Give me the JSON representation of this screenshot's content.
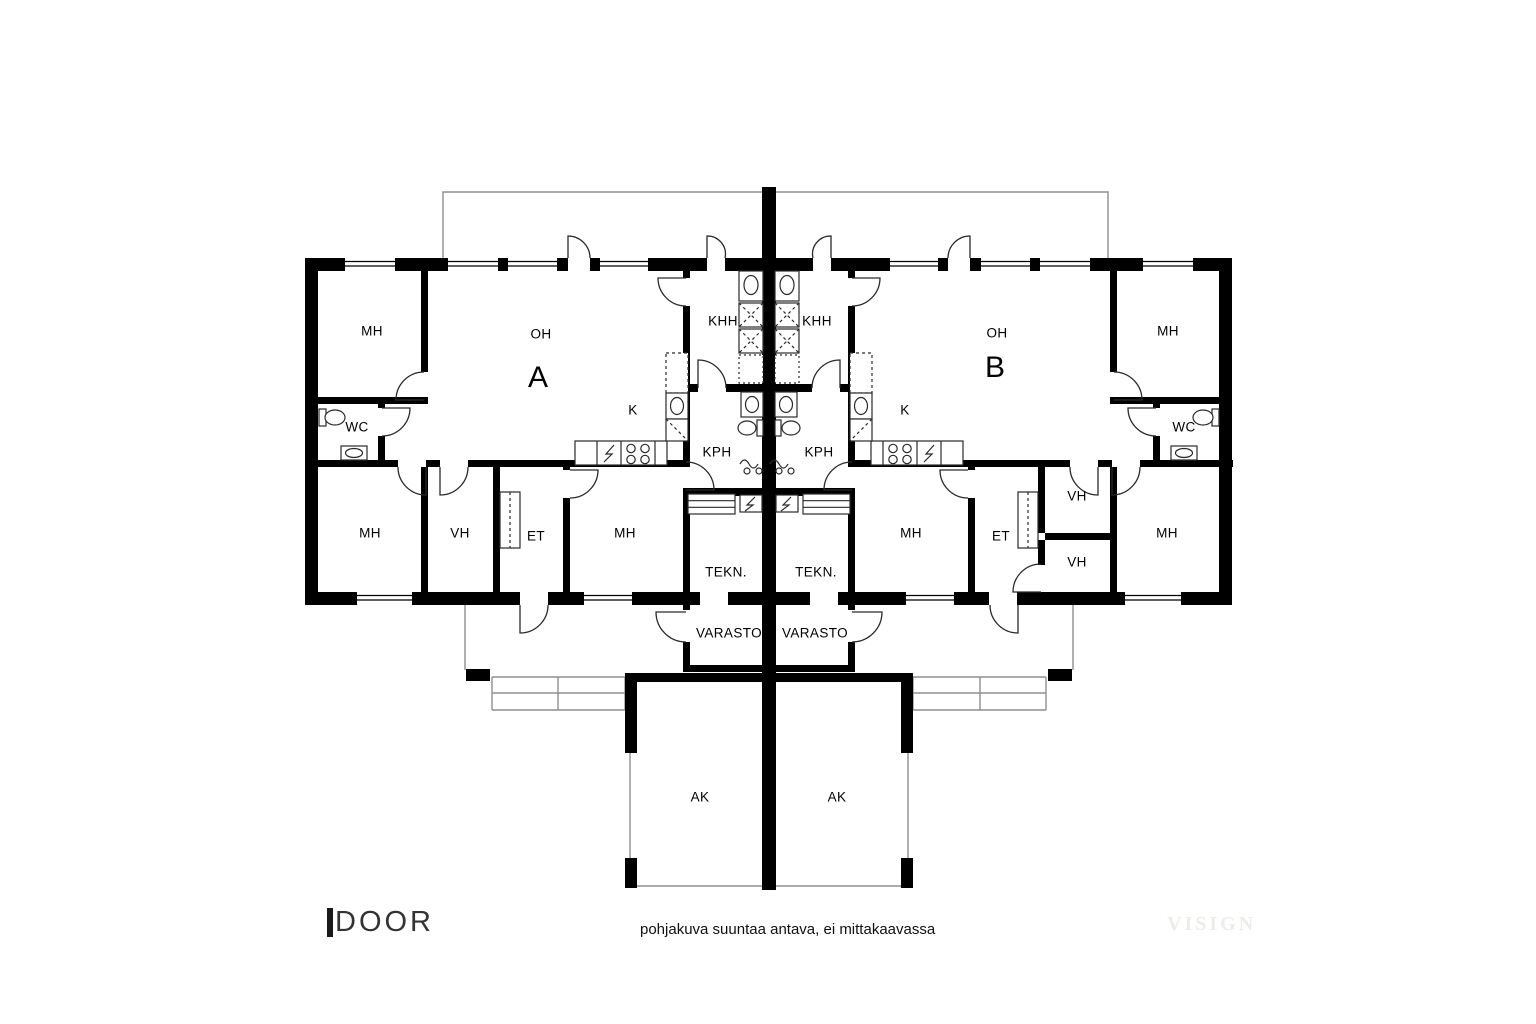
{
  "title": "pohjakuva (floor plan)",
  "colors": {
    "wall": "#000000",
    "thin_outline": "#8f8f8f",
    "door_arc": "#2a2a2a",
    "logo": "#333333",
    "watermark": "#edece8"
  },
  "floorplan": {
    "labels": [
      {
        "unit": "A",
        "text": "MH",
        "x": 372,
        "y": 331
      },
      {
        "unit": "A",
        "text": "OH",
        "x": 541,
        "y": 334
      },
      {
        "unit": "A",
        "text": "A",
        "x": 538,
        "y": 378,
        "large": true
      },
      {
        "unit": "A",
        "text": "KHH",
        "x": 723,
        "y": 321
      },
      {
        "unit": "A",
        "text": "WC",
        "x": 357,
        "y": 427
      },
      {
        "unit": "A",
        "text": "K",
        "x": 633,
        "y": 410
      },
      {
        "unit": "A",
        "text": "KPH",
        "x": 717,
        "y": 452
      },
      {
        "unit": "A",
        "text": "MH",
        "x": 370,
        "y": 533
      },
      {
        "unit": "A",
        "text": "VH",
        "x": 460,
        "y": 533
      },
      {
        "unit": "A",
        "text": "ET",
        "x": 536,
        "y": 536
      },
      {
        "unit": "A",
        "text": "MH",
        "x": 625,
        "y": 533
      },
      {
        "unit": "A",
        "text": "TEKN.",
        "x": 726,
        "y": 572
      },
      {
        "unit": "A",
        "text": "VARASTO",
        "x": 729,
        "y": 633
      },
      {
        "unit": "A",
        "text": "AK",
        "x": 700,
        "y": 797
      },
      {
        "unit": "B",
        "text": "KHH",
        "x": 817,
        "y": 321
      },
      {
        "unit": "B",
        "text": "OH",
        "x": 997,
        "y": 333
      },
      {
        "unit": "B",
        "text": "B",
        "x": 995,
        "y": 368,
        "large": true
      },
      {
        "unit": "B",
        "text": "MH",
        "x": 1168,
        "y": 331
      },
      {
        "unit": "B",
        "text": "K",
        "x": 905,
        "y": 410
      },
      {
        "unit": "B",
        "text": "WC",
        "x": 1184,
        "y": 427
      },
      {
        "unit": "B",
        "text": "KPH",
        "x": 819,
        "y": 452
      },
      {
        "unit": "B",
        "text": "MH",
        "x": 911,
        "y": 533
      },
      {
        "unit": "B",
        "text": "ET",
        "x": 1001,
        "y": 536
      },
      {
        "unit": "B",
        "text": "VH",
        "x": 1077,
        "y": 496
      },
      {
        "unit": "B",
        "text": "VH",
        "x": 1077,
        "y": 562
      },
      {
        "unit": "B",
        "text": "MH",
        "x": 1167,
        "y": 533
      },
      {
        "unit": "B",
        "text": "TEKN.",
        "x": 816,
        "y": 572
      },
      {
        "unit": "B",
        "text": "VARASTO",
        "x": 815,
        "y": 633
      },
      {
        "unit": "B",
        "text": "AK",
        "x": 837,
        "y": 797
      }
    ]
  },
  "footer": {
    "logo": "DOOR",
    "disclaimer": "pohjakuva suuntaa antava, ei mittakaavassa",
    "watermark": "VISIGN"
  }
}
